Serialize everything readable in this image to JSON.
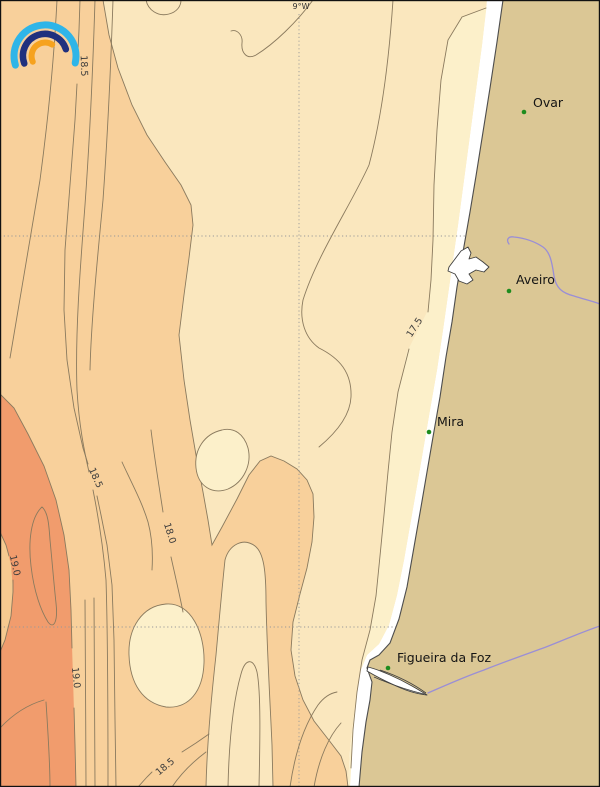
{
  "map": {
    "description": "Coastal contour map of central Portugal shoreline with shaded isotherm bands",
    "axis_labels": {
      "top_meridian": "9°W"
    },
    "towns": [
      {
        "name": "Ovar"
      },
      {
        "name": "Aveiro"
      },
      {
        "name": "Mira"
      },
      {
        "name": "Figueira da Foz"
      }
    ],
    "contour_labels": [
      {
        "value": "18.5"
      },
      {
        "value": "17.5"
      },
      {
        "value": "18.5"
      },
      {
        "value": "18.0"
      },
      {
        "value": "19.0"
      },
      {
        "value": "19.0"
      },
      {
        "value": "18.5"
      }
    ],
    "colors": {
      "band17": "#FCF0CA",
      "band175": "#FAE7BE",
      "band18": "#F8D09B",
      "band185": "#F6CA90",
      "band19": "#F19C6D",
      "land": "#DBC795",
      "coast": "#4d4d4d",
      "contour": "#8a7a5e",
      "river": "#9a8ed6",
      "grid": "#999999",
      "town": "#1e8c1e",
      "labelText": "#3c3c3c",
      "logoBlue": "#2FB5E8",
      "logoNavy": "#20307E",
      "logoOrange": "#F6A21E",
      "frame": "#111111"
    },
    "logo": {
      "name": "rainbow-arcs-logo"
    }
  }
}
